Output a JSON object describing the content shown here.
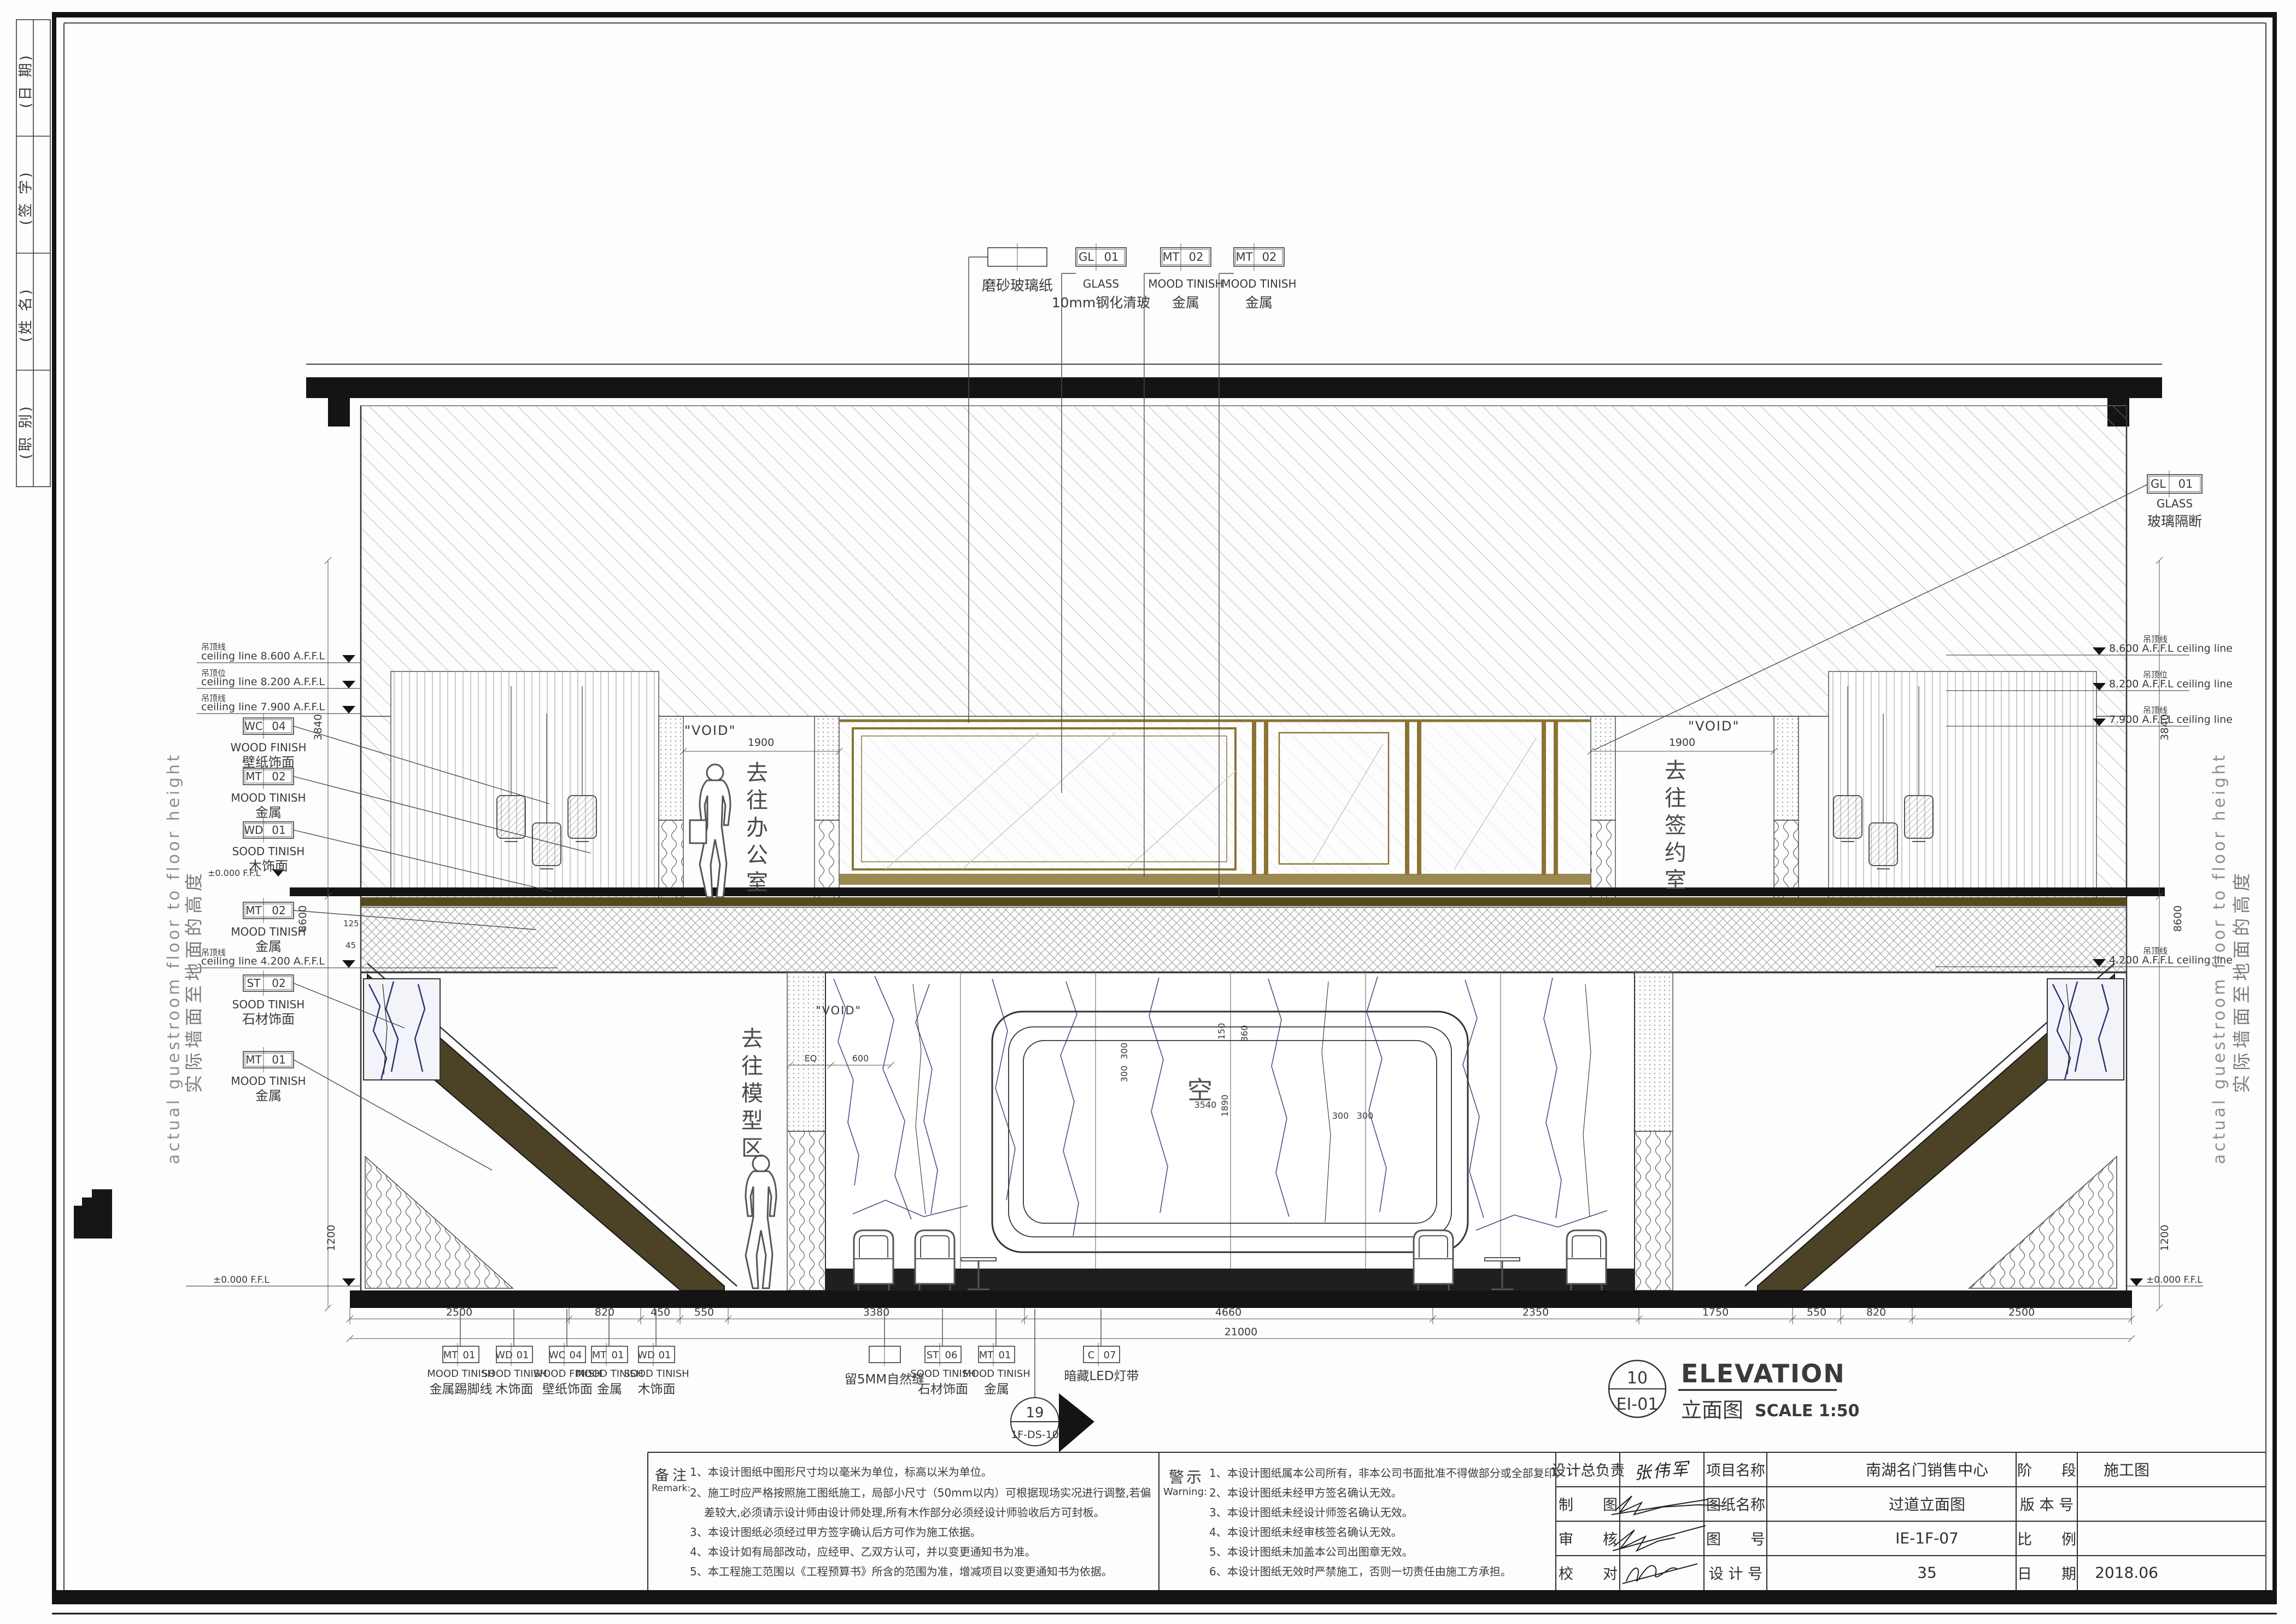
{
  "sheet_title": "过道立面图 EI-01 ELEVATION 1:50",
  "revision_strip": {
    "cells": [
      "(日 期)",
      "(签 字)",
      "(姓 名)",
      "(职 别)"
    ]
  },
  "side_text": {
    "en": "actual guestroom floor to floor height",
    "zh": "实际墙面至地面的高度"
  },
  "levels": {
    "left": [
      {
        "zh": "吊顶线",
        "en": "ceiling line 8.600 A.F.F.L"
      },
      {
        "zh": "吊顶位",
        "en": "ceiling line 8.200 A.F.F.L"
      },
      {
        "zh": "吊顶线",
        "en": "ceiling line 7.900 A.F.F.L"
      },
      {
        "zh": "吊顶线",
        "en": "ceiling line 4.200 A.F.F.L"
      },
      {
        "zh": "",
        "en": "±0.000 F.F.L"
      }
    ],
    "right": [
      {
        "zh": "吊顶线",
        "en": "8.600 A.F.F.L ceiling line"
      },
      {
        "zh": "吊顶位",
        "en": "8.200 A.F.F.L ceiling line"
      },
      {
        "zh": "吊顶线",
        "en": "7.900 A.F.F.L ceiling line"
      },
      {
        "zh": "吊顶线",
        "en": "4.200 A.F.F.L ceiling line"
      },
      {
        "zh": "",
        "en": "±0.000 F.F.L"
      }
    ]
  },
  "callouts": {
    "top": [
      {
        "code": "",
        "num": "",
        "en": "",
        "zh": "磨砂玻璃纸"
      },
      {
        "code": "GL",
        "num": "01",
        "en": "GLASS",
        "zh": "10mm钢化清玻"
      },
      {
        "code": "MT",
        "num": "02",
        "en": "MOOD TINISH",
        "zh": "金属"
      },
      {
        "code": "MT",
        "num": "02",
        "en": "MOOD TINISH",
        "zh": "金属"
      }
    ],
    "right": {
      "code": "GL",
      "num": "01",
      "en": "GLASS",
      "zh": "玻璃隔断"
    },
    "left": [
      {
        "code": "WC",
        "num": "04",
        "en": "WOOD FINISH",
        "zh": "壁纸饰面"
      },
      {
        "code": "MT",
        "num": "02",
        "en": "MOOD TINISH",
        "zh": "金属"
      },
      {
        "code": "WD",
        "num": "01",
        "en": "SOOD TINISH",
        "zh": "木饰面"
      },
      {
        "code": "MT",
        "num": "02",
        "en": "MOOD TINISH",
        "zh": "金属"
      },
      {
        "code": "ST",
        "num": "02",
        "en": "SOOD TINISH",
        "zh": "石材饰面"
      },
      {
        "code": "MT",
        "num": "01",
        "en": "MOOD TINISH",
        "zh": "金属"
      }
    ],
    "bottom": [
      {
        "code": "MT",
        "num": "01",
        "en": "MOOD TINISH",
        "zh": "金属踢脚线"
      },
      {
        "code": "WD",
        "num": "01",
        "en": "SOOD TINISH",
        "zh": "木饰面"
      },
      {
        "code": "WC",
        "num": "04",
        "en": "WOOD FINISH",
        "zh": "壁纸饰面"
      },
      {
        "code": "MT",
        "num": "01",
        "en": "MOOD TINISH",
        "zh": "金属"
      },
      {
        "code": "WD",
        "num": "01",
        "en": "SOOD TINISH",
        "zh": "木饰面"
      },
      {
        "code": "",
        "num": "",
        "en": "",
        "zh": "留5MM自然缝"
      },
      {
        "code": "ST",
        "num": "06",
        "en": "SOOD TINISH",
        "zh": "石材饰面"
      },
      {
        "code": "MT",
        "num": "01",
        "en": "MOOD TINISH",
        "zh": "金属"
      },
      {
        "code": "C",
        "num": "07",
        "en": "",
        "zh": "暗藏LED灯带"
      }
    ]
  },
  "rooms": {
    "office": "去往办公室",
    "signing": "去往签约室",
    "model": "去往模型区",
    "void": "\"VOID\"",
    "empty": "空"
  },
  "dims": {
    "bottom": [
      "2500",
      "820",
      "450",
      "550",
      "3380",
      "4660",
      "2350",
      "1750",
      "550",
      "820",
      "2500"
    ],
    "total": "21000",
    "vertical": [
      "3840",
      "8600",
      "125",
      "45",
      "1200"
    ],
    "glass_left": "1900",
    "glass_right": "1900",
    "frame": [
      "300",
      "300",
      "150",
      "360",
      "3540",
      "1890",
      "300",
      "300"
    ],
    "panel_eq": "EQ",
    "panel_600": "600"
  },
  "detail_marker": {
    "top": "19",
    "bottom": "1F-DS-10"
  },
  "view_title": {
    "num": "10",
    "ref": "EI-01",
    "en": "ELEVATION",
    "zh": "立面图",
    "scale": "SCALE 1:50"
  },
  "notes": {
    "zh": "备注",
    "en": "Remark:",
    "items": [
      "1、本设计图纸中图形尺寸均以毫米为单位，标高以米为单位。",
      "2、施工时应严格按照施工图纸施工，局部小尺寸（50mm以内）可根据现场实况进行调整,若偏",
      "差较大,必须请示设计师由设计师处理,所有木作部分必须经设计师验收后方可封板。",
      "3、本设计图纸必须经过甲方签字确认后方可作为施工依据。",
      "4、本设计如有局部改动，应经甲、乙双方认可，并以变更通知书为准。",
      "5、本工程施工范围以《工程预算书》所含的范围为准，增减项目以变更通知书为依据。"
    ]
  },
  "warnings": {
    "zh": "警示",
    "en": "Warning:",
    "items": [
      "1、本设计图纸属本公司所有，非本公司书面批准不得做部分或全部复印。",
      "2、本设计图纸未经甲方签名确认无效。",
      "3、本设计图纸未经设计师签名确认无效。",
      "4、本设计图纸未经审核签名确认无效。",
      "5、本设计图纸未加盖本公司出图章无效。",
      "6、本设计图纸无效时严禁施工，否则一切责任由施工方承担。"
    ]
  },
  "title_block": {
    "chief_label": "设计总负责",
    "chief_sign": "张伟军",
    "draft_label": "制　　图",
    "check_label": "审　　核",
    "proof_label": "校　　对",
    "project_label": "项目名称",
    "project_value": "南湖名门销售中心",
    "drawing_label": "图纸名称",
    "drawing_value": "过道立面图",
    "number_label": "图　　号",
    "number_value": "IE-1F-07",
    "design_label": "设 计 号",
    "design_value": "35",
    "stage_label": "阶　　段",
    "stage_value": "施工图",
    "version_label": "版 本 号",
    "version_value": "",
    "scale_label": "比　　例",
    "scale_value": "",
    "date_label": "日　　期",
    "date_value": "2018.06"
  },
  "colors": {
    "gold": "#8a7434",
    "olive": "#4f4526",
    "vein": "#2a3570",
    "ink": "#141414"
  }
}
